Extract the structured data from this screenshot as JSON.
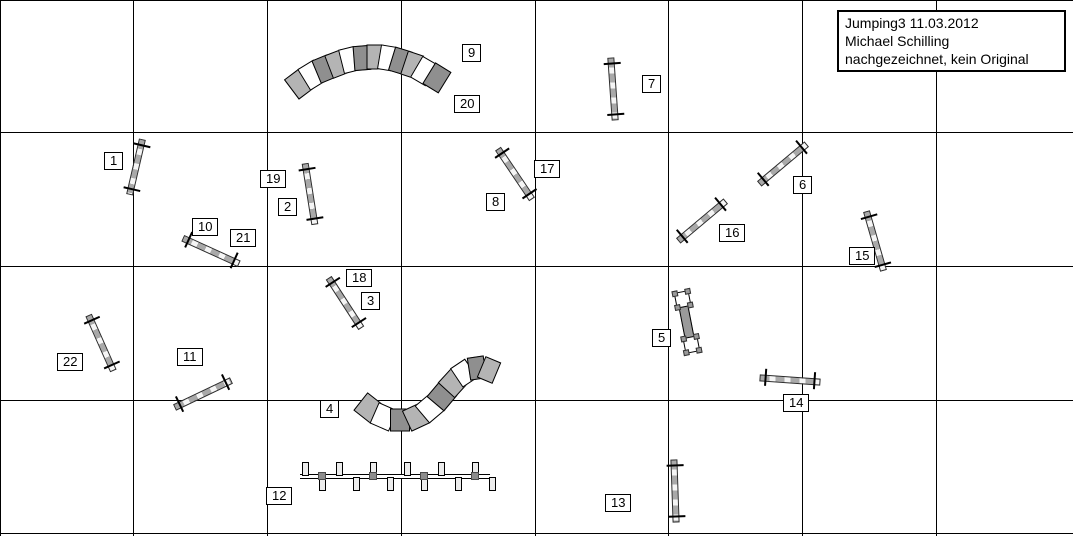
{
  "title_box": {
    "lines": [
      "Jumping3 11.03.2012",
      "Michael Schilling",
      "nachgezeichnet, kein Original"
    ]
  },
  "colors": {
    "line_black": "#000000",
    "obstacle_gray": "#a9a9a9",
    "tunnel_light": "#b4b4b4",
    "tunnel_white": "#ffffff",
    "tunnel_dark": "#8f8f8f"
  },
  "grid": {
    "vertical_x": [
      0,
      133,
      267,
      401,
      535,
      668,
      802,
      936
    ],
    "horizontal_y": [
      0,
      132,
      266,
      400,
      533
    ]
  },
  "labels": [
    {
      "text": "1",
      "x": 104,
      "y": 152
    },
    {
      "text": "2",
      "x": 278,
      "y": 198
    },
    {
      "text": "3",
      "x": 361,
      "y": 292
    },
    {
      "text": "4",
      "x": 320,
      "y": 400
    },
    {
      "text": "5",
      "x": 652,
      "y": 329
    },
    {
      "text": "6",
      "x": 793,
      "y": 176
    },
    {
      "text": "7",
      "x": 642,
      "y": 75
    },
    {
      "text": "8",
      "x": 486,
      "y": 193
    },
    {
      "text": "9",
      "x": 462,
      "y": 44
    },
    {
      "text": "10",
      "x": 192,
      "y": 218
    },
    {
      "text": "11",
      "x": 177,
      "y": 348
    },
    {
      "text": "12",
      "x": 266,
      "y": 487
    },
    {
      "text": "13",
      "x": 605,
      "y": 494
    },
    {
      "text": "14",
      "x": 783,
      "y": 394
    },
    {
      "text": "15",
      "x": 849,
      "y": 247
    },
    {
      "text": "16",
      "x": 719,
      "y": 224
    },
    {
      "text": "17",
      "x": 534,
      "y": 160
    },
    {
      "text": "18",
      "x": 346,
      "y": 269
    },
    {
      "text": "19",
      "x": 260,
      "y": 170
    },
    {
      "text": "20",
      "x": 454,
      "y": 95
    },
    {
      "text": "21",
      "x": 230,
      "y": 229
    },
    {
      "text": "22",
      "x": 57,
      "y": 353
    }
  ],
  "obstacles": {
    "jumps": [
      {
        "type": "jump",
        "numbers": [
          "1"
        ],
        "cx": 136,
        "cy": 167,
        "length": 55,
        "angle": 103
      },
      {
        "type": "jump",
        "numbers": [
          "2",
          "19"
        ],
        "cx": 310,
        "cy": 194,
        "length": 60,
        "angle": 81
      },
      {
        "type": "jump",
        "numbers": [
          "3",
          "18"
        ],
        "cx": 345,
        "cy": 303,
        "length": 58,
        "angle": 57
      },
      {
        "type": "jump",
        "numbers": [
          "6"
        ],
        "cx": 783,
        "cy": 164,
        "length": 60,
        "angle": -40
      },
      {
        "type": "jump",
        "numbers": [
          "7"
        ],
        "cx": 613,
        "cy": 89,
        "length": 61,
        "angle": 86
      },
      {
        "type": "jump",
        "numbers": [
          "8",
          "17"
        ],
        "cx": 515,
        "cy": 174,
        "length": 59,
        "angle": 56
      },
      {
        "type": "jump",
        "numbers": [
          "10",
          "21"
        ],
        "cx": 211,
        "cy": 251,
        "length": 60,
        "angle": 24.5
      },
      {
        "type": "jump",
        "numbers": [
          "11"
        ],
        "cx": 203,
        "cy": 394,
        "length": 61,
        "angle": -25.5
      },
      {
        "type": "jump",
        "numbers": [
          "13"
        ],
        "cx": 675,
        "cy": 491,
        "length": 61,
        "angle": 88
      },
      {
        "type": "jump",
        "numbers": [
          "14"
        ],
        "cx": 790,
        "cy": 380,
        "length": 59,
        "angle": 4
      },
      {
        "type": "jump",
        "numbers": [
          "15"
        ],
        "cx": 875,
        "cy": 241,
        "length": 60,
        "angle": 74
      },
      {
        "type": "jump",
        "numbers": [
          "16"
        ],
        "cx": 702,
        "cy": 221,
        "length": 60,
        "angle": -40
      },
      {
        "type": "jump",
        "numbers": [
          "22"
        ],
        "cx": 101,
        "cy": 343,
        "length": 59,
        "angle": 66
      }
    ],
    "tunnels": [
      {
        "type": "tunnel",
        "numbers": [
          "9",
          "20"
        ],
        "diameter": 23,
        "path": [
          [
            293,
            88
          ],
          [
            305,
            79
          ],
          [
            318,
            71
          ],
          [
            330,
            66
          ],
          [
            343,
            61
          ],
          [
            355,
            58
          ],
          [
            368,
            57
          ],
          [
            381,
            57
          ],
          [
            393,
            59
          ],
          [
            406,
            63
          ],
          [
            418,
            67
          ],
          [
            430,
            74
          ],
          [
            443,
            82
          ]
        ]
      },
      {
        "type": "tunnel",
        "numbers": [
          "4"
        ],
        "diameter": 21,
        "path": [
          [
            362,
            402
          ],
          [
            376,
            413
          ],
          [
            392,
            420
          ],
          [
            408,
            420
          ],
          [
            423,
            413
          ],
          [
            436,
            402
          ],
          [
            447,
            389
          ],
          [
            458,
            377
          ],
          [
            470,
            369
          ],
          [
            483,
            367
          ],
          [
            495,
            372
          ]
        ]
      }
    ],
    "weave": {
      "type": "weave-poles",
      "number": "12",
      "x": 300,
      "y": 474,
      "length": 190,
      "pole_count": 12,
      "pole_spacing": 17
    },
    "wall": {
      "type": "wall",
      "number": "5",
      "cx": 687,
      "cy": 322,
      "length": 52,
      "angle": 79
    }
  }
}
